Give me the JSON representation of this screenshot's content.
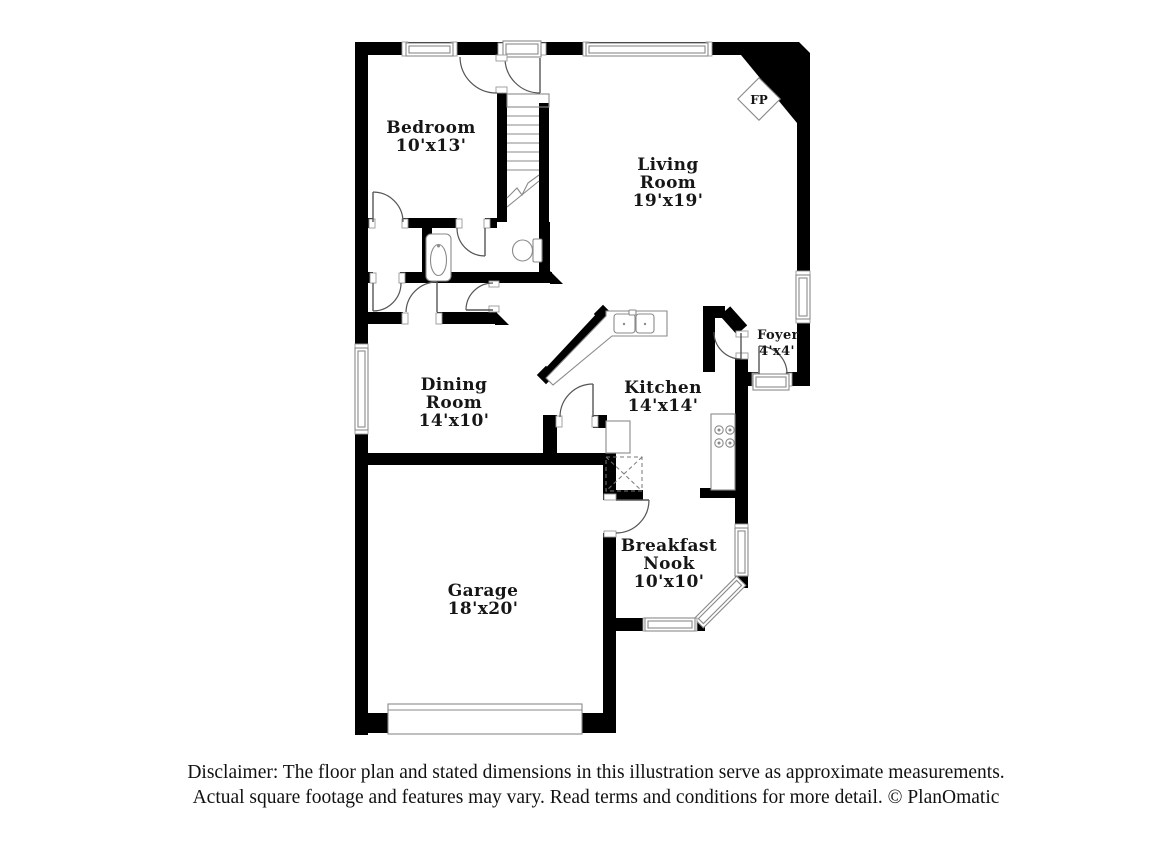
{
  "floor_plan": {
    "rooms": [
      {
        "id": "bedroom",
        "label_lines": [
          "Bedroom",
          "10'x13'"
        ]
      },
      {
        "id": "living-room",
        "label_lines": [
          "Living",
          "Room",
          "19'x19'"
        ]
      },
      {
        "id": "foyer",
        "label_lines": [
          "Foyer",
          "4'x4'"
        ]
      },
      {
        "id": "dining-room",
        "label_lines": [
          "Dining",
          "Room",
          "14'x10'"
        ]
      },
      {
        "id": "kitchen",
        "label_lines": [
          "Kitchen",
          "14'x14'"
        ]
      },
      {
        "id": "breakfast-nook",
        "label_lines": [
          "Breakfast",
          "Nook",
          "10'x10'"
        ]
      },
      {
        "id": "garage",
        "label_lines": [
          "Garage",
          "18'x20'"
        ]
      }
    ],
    "fireplace_label": "FP",
    "colors": {
      "wall": "#000000",
      "fixture_stroke": "#8a8a8a",
      "label": "#161616"
    }
  },
  "disclaimer": {
    "line1": "Disclaimer: The floor plan and stated dimensions in this illustration serve as approximate measurements.",
    "line2": "Actual square footage and features may vary. Read terms and conditions for more detail. © PlanOmatic"
  }
}
